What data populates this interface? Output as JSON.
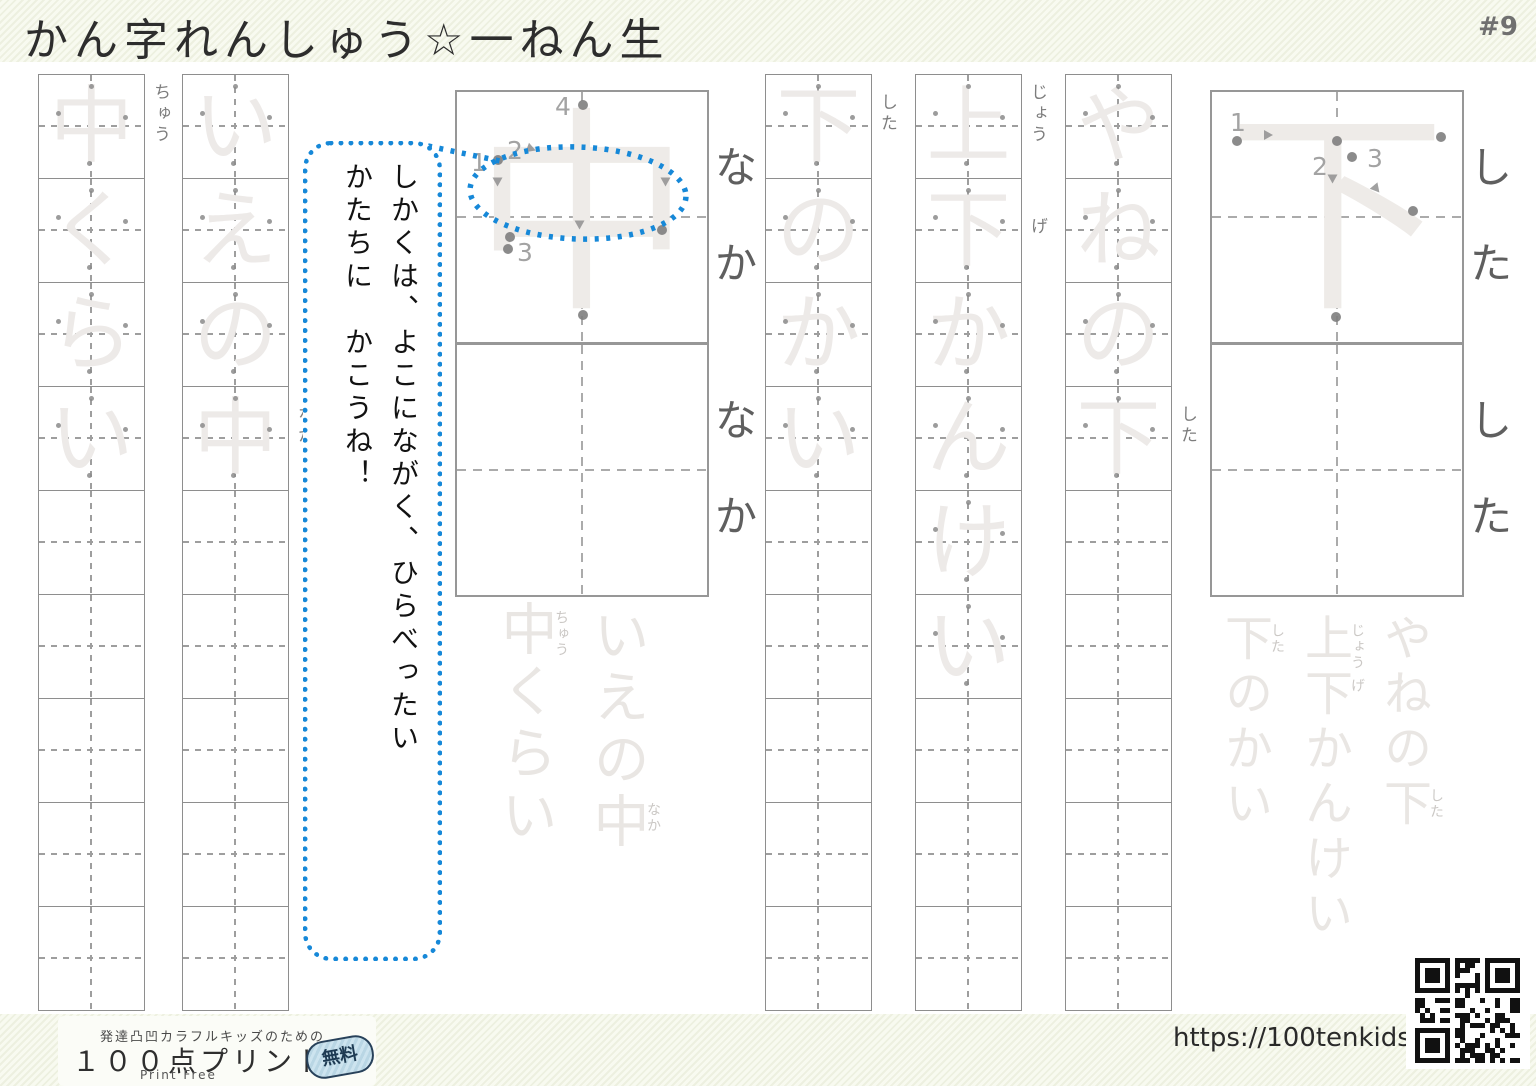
{
  "page": {
    "title": "かん字れんしゅう☆一ねん生",
    "number": "#9"
  },
  "columns": [
    {
      "phrase": "中くらい",
      "chars": [
        "中",
        "く",
        "ら",
        "い"
      ],
      "furigana": [
        {
          "index": 0,
          "text": "ちゅう"
        }
      ],
      "total_squares": 9
    },
    {
      "phrase": "いえの中",
      "chars": [
        "い",
        "え",
        "の",
        "中"
      ],
      "furigana": [
        {
          "index": 3,
          "text": "なか"
        }
      ],
      "total_squares": 9
    },
    {
      "phrase": "下のかい",
      "chars": [
        "下",
        "の",
        "か",
        "い"
      ],
      "furigana": [
        {
          "index": 0,
          "text": "した"
        }
      ],
      "total_squares": 9
    },
    {
      "phrase": "上下かんけい",
      "chars": [
        "上",
        "下",
        "か",
        "ん",
        "け",
        "い"
      ],
      "furigana": [
        {
          "index": 0,
          "text": "じょう"
        },
        {
          "index": 1,
          "text": "げ"
        }
      ],
      "total_squares": 9
    },
    {
      "phrase": "やねの下",
      "chars": [
        "や",
        "ね",
        "の",
        "下"
      ],
      "furigana": [
        {
          "index": 3,
          "text": "した"
        }
      ],
      "total_squares": 9
    }
  ],
  "bubble": {
    "line1": "しかくは、よこにながく、ひらべったい",
    "line2": "かたちに　かこうね！"
  },
  "big_boxes": [
    {
      "char": "中",
      "readings": [
        "な",
        "か"
      ],
      "stroke_numbers": [
        "1",
        "2",
        "3",
        "4"
      ]
    },
    {
      "char": "",
      "readings": [
        "な",
        "か"
      ],
      "stroke_numbers": []
    },
    {
      "char": "下",
      "readings": [
        "し",
        "た"
      ],
      "stroke_numbers": [
        "1",
        "2",
        "3"
      ]
    },
    {
      "char": "",
      "readings": [
        "し",
        "た"
      ],
      "stroke_numbers": []
    }
  ],
  "faint_groups": [
    {
      "columns": [
        {
          "text": "いえの中",
          "furigana": [
            {
              "index": 3,
              "text": "なか"
            }
          ]
        },
        {
          "text": "中くらい",
          "furigana": [
            {
              "index": 0,
              "text": "ちゅう"
            }
          ]
        }
      ]
    },
    {
      "columns": [
        {
          "text": "やねの下",
          "furigana": [
            {
              "index": 3,
              "text": "した"
            }
          ]
        },
        {
          "text": "上下かんけい",
          "furigana": [
            {
              "index": 0,
              "text": "じょう"
            },
            {
              "index": 1,
              "text": "げ"
            }
          ]
        },
        {
          "text": "下のかい",
          "furigana": [
            {
              "index": 0,
              "text": "した"
            }
          ]
        }
      ]
    }
  ],
  "footer": {
    "tagline": "発達凸凹カラフルキッズのための",
    "logo": "１００点プリント",
    "sub": "Print Free",
    "badge": "無料",
    "url": "https://100tenkids.com/"
  },
  "colors": {
    "accent_blue": "#1688d8",
    "stripe_green": "#edf0e0",
    "trace_gray": "#edeae8"
  }
}
